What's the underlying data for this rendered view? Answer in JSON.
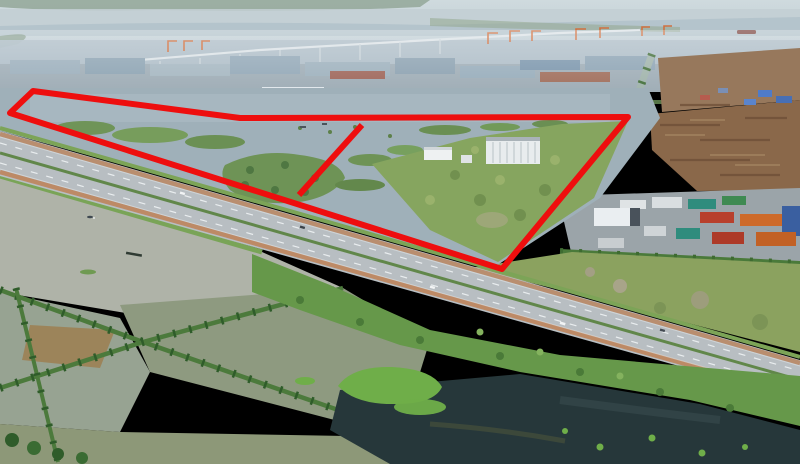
{
  "meta": {
    "kind": "aerial-drone-photograph",
    "subject": "coastal industrial land plot outlined in red, beside a container port, highway and flooded fish ponds",
    "width_px": 800,
    "height_px": 464
  },
  "annotation": {
    "label": "site-boundary-outline",
    "color": "#ee0e0e",
    "stroke_width": 6,
    "boundary_points": "33,91 240,118 628,117 502,269 10,113",
    "divider_points": "362,125 299,195"
  },
  "palette": {
    "sky_haze": "#c7d4d9",
    "river": "#c3cfd4",
    "port_haze": "#aebdc7",
    "flood_water": "#9fb0b9",
    "marsh_green": "#6e9356",
    "grass_field": "#86a55f",
    "road_asphalt": "#b8bec2",
    "road_median_green": "#61874a",
    "road_curb_brown": "#b98e6f",
    "pond_gray": "#afb3a8",
    "pond_olive": "#8e9a80",
    "pond_brown": "#9c8154",
    "dark_pond": "#26373a",
    "floating_weed_green": "#6fae49",
    "reed_green": "#66984a",
    "berm_tree_green": "#2f5c2a",
    "timber_brown": "#8a684a",
    "container_red": "#b8402c",
    "container_orange": "#cd6a2a",
    "container_teal": "#2f8c7d",
    "container_blue": "#3a5fa0",
    "warehouse_white": "#e9edf0",
    "crane_orange": "#cf7040",
    "tarp_blue": "#4f7bc8",
    "pavement_gray": "#9ba4a9"
  }
}
